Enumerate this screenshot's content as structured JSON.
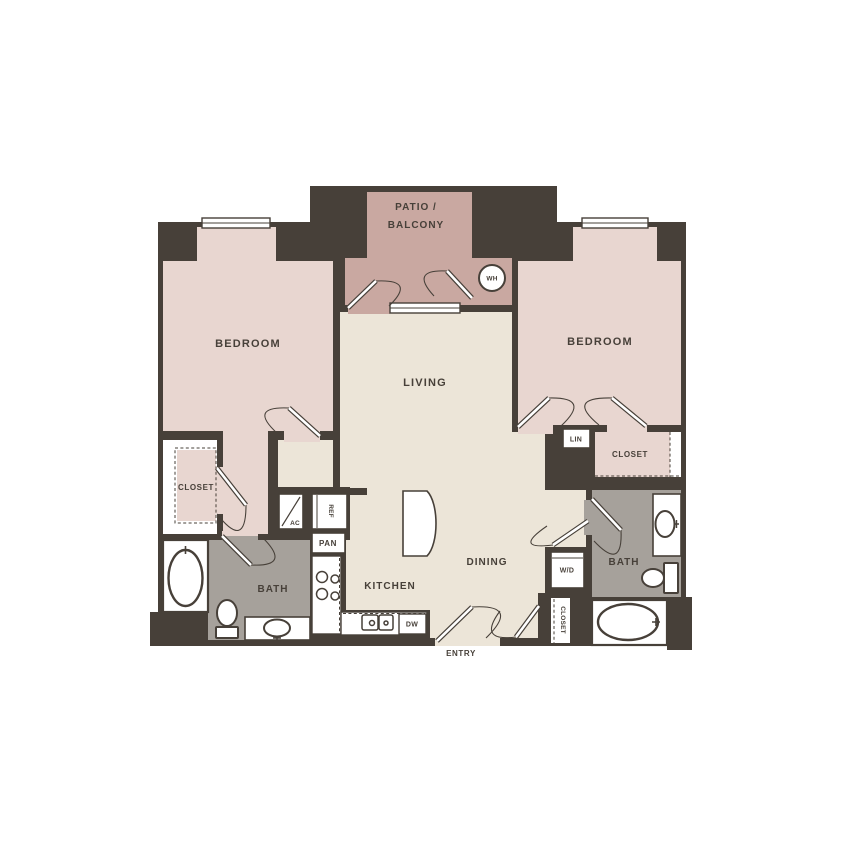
{
  "floorplan": {
    "rooms": {
      "bedroom_left": "BEDROOM",
      "bedroom_right": "BEDROOM",
      "living": "LIVING",
      "dining": "DINING",
      "kitchen": "KITCHEN",
      "patio_line1": "PATIO /",
      "patio_line2": "BALCONY",
      "bath_left": "BATH",
      "bath_right": "BATH",
      "closet_left": "CLOSET",
      "closet_bedroom_right": "CLOSET",
      "closet_entry": "CLOSET",
      "linen": "LIN",
      "entry": "ENTRY"
    },
    "fixtures": {
      "water_heater": "WH",
      "refrigerator": "REF",
      "pantry": "PAN",
      "hvac": "AC",
      "washer_dryer": "W/D",
      "dishwasher": "DW"
    },
    "colors": {
      "wall": "#474039",
      "bedroom_fill": "#e8d6d0",
      "patio_fill": "#c9a8a1",
      "living_fill": "#ece5d8",
      "bath_fill": "#a6a19b",
      "background": "#ffffff"
    }
  }
}
